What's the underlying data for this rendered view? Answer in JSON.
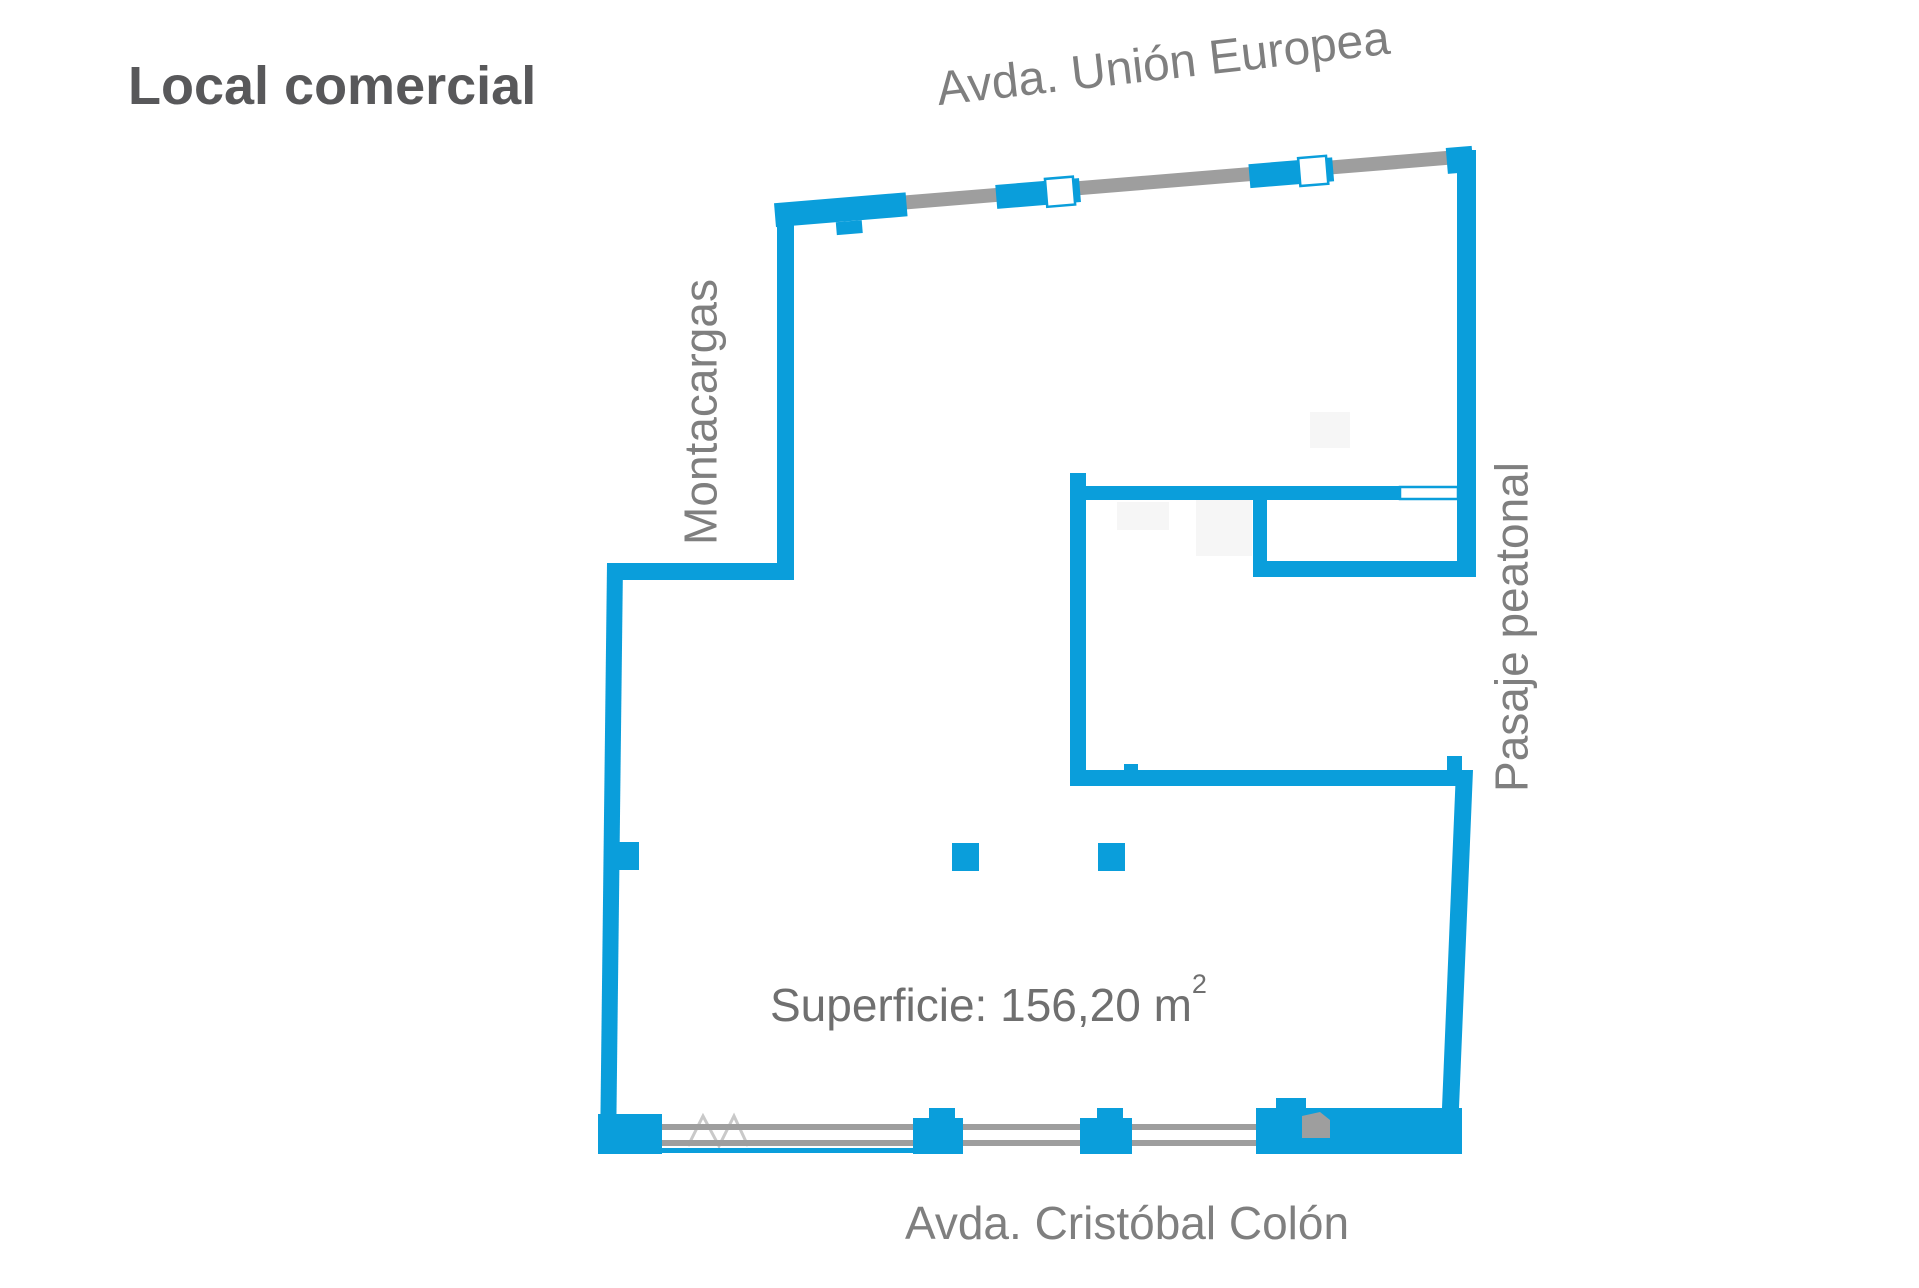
{
  "title": "Local comercial",
  "labels": {
    "top_street": "Avda. Unión Europea",
    "left_vertical": "Montacargas",
    "right_vertical": "Pasaje peatonal",
    "bottom_street": "Avda. Cristóbal Colón",
    "area_text": "Superficie: 156,20 m",
    "area_sup": "2"
  },
  "floorplan": {
    "type": "commercial-premises-plan",
    "area_m2": "156,20",
    "facades": [
      "Avda. Unión Europea",
      "Avda. Cristóbal Colón",
      "Pasaje peatonal"
    ],
    "service": "Montacargas"
  },
  "colors": {
    "wall_blue": "#0a9edb",
    "glazing_gray": "#9e9e9e",
    "label_gray": "#7f7f7f",
    "title_gray": "#58585a"
  }
}
